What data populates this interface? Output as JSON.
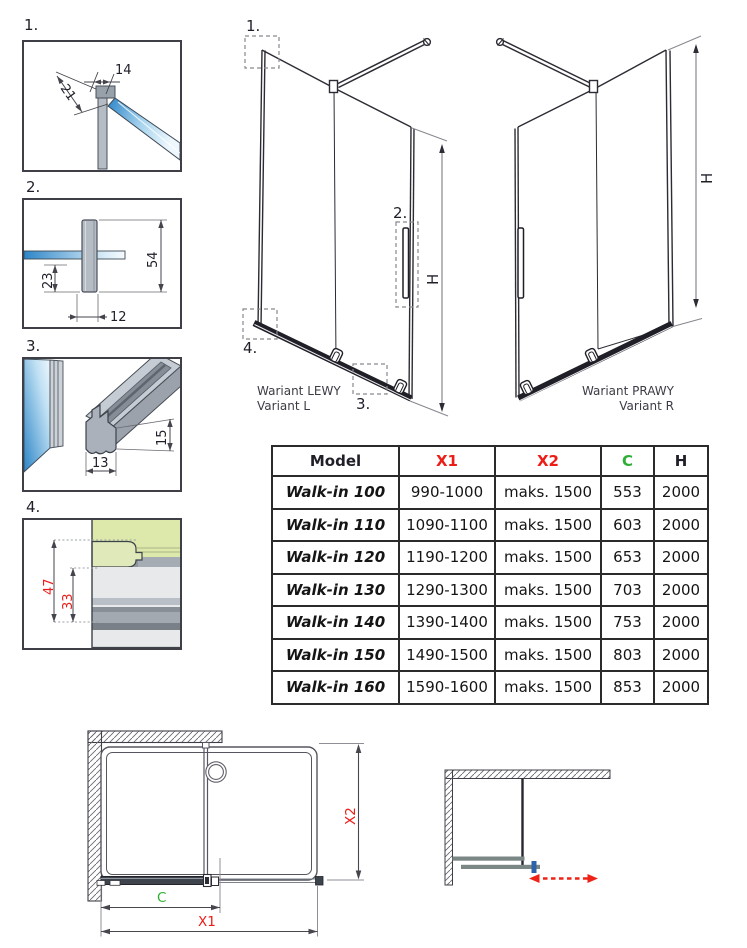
{
  "details": {
    "d1": {
      "num": "1.",
      "dim_top": "14",
      "dim_diag": "21"
    },
    "d2": {
      "num": "2.",
      "dim_total": "54",
      "dim_lower": "23",
      "dim_width": "12"
    },
    "d3": {
      "num": "3.",
      "dim_height": "15",
      "dim_width": "13"
    },
    "d4": {
      "num": "4.",
      "dim_outer": "47",
      "dim_inner": "33"
    }
  },
  "variants": {
    "left": {
      "title": "Wariant LEWY",
      "subtitle": "Variant L",
      "height_label": "H",
      "callout_1": "1.",
      "callout_2": "2.",
      "callout_3": "3.",
      "callout_4": "4."
    },
    "right": {
      "title": "Wariant PRAWY",
      "subtitle": "Variant R",
      "height_label": "H"
    }
  },
  "table": {
    "headers": {
      "model": "Model",
      "x1": "X1",
      "x2": "X2",
      "c": "C",
      "h": "H"
    },
    "rows": [
      {
        "model": "Walk-in 100",
        "x1": "990-1000",
        "x2": "maks. 1500",
        "c": "553",
        "h": "2000"
      },
      {
        "model": "Walk-in 110",
        "x1": "1090-1100",
        "x2": "maks. 1500",
        "c": "603",
        "h": "2000"
      },
      {
        "model": "Walk-in 120",
        "x1": "1190-1200",
        "x2": "maks. 1500",
        "c": "653",
        "h": "2000"
      },
      {
        "model": "Walk-in 130",
        "x1": "1290-1300",
        "x2": "maks. 1500",
        "c": "703",
        "h": "2000"
      },
      {
        "model": "Walk-in 140",
        "x1": "1390-1400",
        "x2": "maks. 1500",
        "c": "753",
        "h": "2000"
      },
      {
        "model": "Walk-in 150",
        "x1": "1490-1500",
        "x2": "maks. 1500",
        "c": "803",
        "h": "2000"
      },
      {
        "model": "Walk-in 160",
        "x1": "1590-1600",
        "x2": "maks. 1500",
        "c": "853",
        "h": "2000"
      }
    ]
  },
  "plan": {
    "dim_c": "C",
    "dim_x1": "X1",
    "dim_x2": "X2"
  },
  "colors": {
    "dimension_red": "#ed1c16",
    "dimension_green": "#2fae35",
    "glass_blue": "#2e86c8",
    "glass_green": "#dde9ab",
    "profile_grey": "#aab1ba",
    "line_dark": "#2c2c34",
    "arrow_red": "#ee2217",
    "handle_blue": "#2c63a8"
  }
}
